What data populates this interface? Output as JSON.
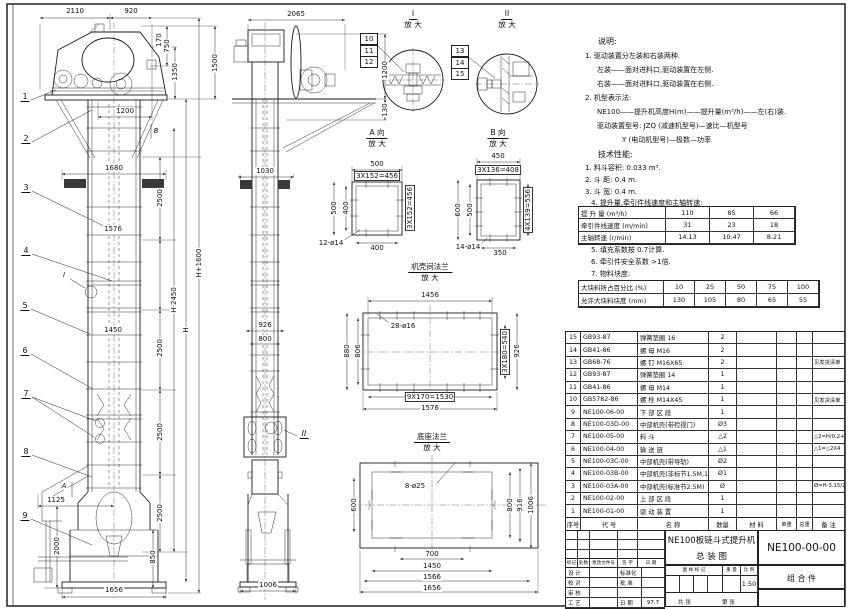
{
  "views": {
    "front": {
      "top_w1": "2110",
      "top_w2": "920",
      "r1": "170",
      "r2": "750",
      "r3": "1350",
      "r4": "1500",
      "discharge": "1200",
      "pad_w": "1680",
      "seg": "2500",
      "flange_w": "1576",
      "inner_w": "1450",
      "h_minus": "H-2450",
      "h": "H",
      "h_plus": "H+1600",
      "inlet": "1125",
      "boot_h1": "2000",
      "boot_h2": "850",
      "base_w": "1656",
      "callouts": [
        "1",
        "2",
        "3",
        "4",
        "5",
        "6",
        "7",
        "8",
        "9"
      ],
      "marker_i": "I",
      "marker_a": "A",
      "marker_b": "B"
    },
    "side": {
      "top_w": "2065",
      "r1": "1200",
      "r2": "130",
      "pad_w": "1030",
      "depth": "926",
      "inner_d": "800",
      "base_w": "1006",
      "marker_ii": "II"
    },
    "detailI": {
      "t": "I",
      "sub": "放 大",
      "c": [
        "10",
        "11",
        "12"
      ]
    },
    "detailII": {
      "t": "II",
      "sub": "放 大",
      "c": [
        "13",
        "14",
        "15"
      ]
    },
    "viewA": {
      "t": "A 向",
      "sub": "放 大",
      "top1": "500",
      "top2": "3X152=456",
      "left1": "500",
      "left2": "400",
      "right1": "3X152=456",
      "bottom": "400",
      "holes": "12-ø14"
    },
    "viewB": {
      "t": "B 向",
      "sub": "放 大",
      "top1": "450",
      "top2": "3X136=408",
      "left1": "600",
      "left2": "500",
      "right1": "4X139=556",
      "bottom": "350",
      "holes": "14-ø14"
    },
    "flange": {
      "t": "机壳间法兰",
      "sub": "放 大",
      "top": "1456",
      "holes": "28-ø16",
      "left1": "880",
      "left2": "806",
      "right1": "3X180=540",
      "right2": "926",
      "bottom1": "9X170=1530",
      "bottom2": "1576"
    },
    "base": {
      "t": "底座法兰",
      "sub": "放 大",
      "holes": "8-ø25",
      "left": "600",
      "right1": "800",
      "right2": "916",
      "right3": "1006",
      "b1": "700",
      "b2": "1450",
      "b3": "1566",
      "b4": "1656"
    }
  },
  "notes": {
    "heading": "说明:",
    "n1": "1. 驱动装置分左装和右装两种.",
    "n2": "左装——面对进料口,驱动装置在左侧.",
    "n3": "右装——面对进料口,驱动装置在右侧.",
    "n4": "2. 机型表示法:",
    "n5": "NE100——提升机高度H(m)——提升量(m³/h)——左(右)装.",
    "n6": "驱动装置型号: JZQ (减速机型号)—速比—机型号",
    "n7": "Y (电动机型号)—极数—功率"
  },
  "specs": {
    "heading": "技术性能:",
    "s1": "1. 料斗容积: 0.033 m³.",
    "s2": "2. 斗  距: 0.4 m.",
    "s3": "3. 斗  宽: 0.4 m.",
    "s4": "4. 提升量,牵引件线速度和主轴转速:",
    "s5": "5. 填充系数按 0.7计算.",
    "s6": "6. 牵引件安全系数 >1倍.",
    "s7": "7. 物料块度:"
  },
  "perf_table": {
    "rows": [
      {
        "label": "提 升 量  (m³/h)",
        "values": [
          "110",
          "85",
          "66"
        ]
      },
      {
        "label": "牵引件线速度 (m/min)",
        "values": [
          "31",
          "23",
          "18"
        ]
      },
      {
        "label": "主轴转速  (r/min)",
        "values": [
          "14.13",
          "10.47",
          "8.21"
        ]
      }
    ]
  },
  "lump_table": {
    "rows": [
      {
        "label": "大块料所占百分比 (%)",
        "values": [
          "10",
          "25",
          "50",
          "75",
          "100"
        ]
      },
      {
        "label": "允许大块料块度 (mm)",
        "values": [
          "130",
          "105",
          "80",
          "65",
          "55"
        ]
      }
    ]
  },
  "bom": {
    "headers": {
      "no": "序号",
      "code": "代  号",
      "name": "名   称",
      "qty": "数量",
      "material": "材  料",
      "unit": "单重",
      "total": "总重",
      "remark": "备 注"
    },
    "rows": [
      {
        "no": "15",
        "code": "GB93-87",
        "name": "弹簧垫圈  16",
        "qty": "2",
        "remark": ""
      },
      {
        "no": "14",
        "code": "GB41-86",
        "name": "螺 母  M16",
        "qty": "2",
        "remark": ""
      },
      {
        "no": "13",
        "code": "GB68-76",
        "name": "螺 钉  M16X65",
        "qty": "2",
        "remark": "见发货清单"
      },
      {
        "no": "12",
        "code": "GB93-87",
        "name": "弹簧垫圈  14",
        "qty": "1",
        "remark": ""
      },
      {
        "no": "11",
        "code": "GB41-86",
        "name": "螺 母  M14",
        "qty": "1",
        "remark": ""
      },
      {
        "no": "10",
        "code": "GB5782-86",
        "name": "螺 栓  M14X45",
        "qty": "1",
        "remark": "见发货清单"
      },
      {
        "no": "9",
        "code": "NE100-06-00",
        "name": "下 部 区 段",
        "qty": "1",
        "remark": ""
      },
      {
        "no": "8",
        "code": "NE100-03D-00",
        "name": "中部机壳(带检视门)",
        "qty": "Ø3",
        "remark": ""
      },
      {
        "no": "7",
        "code": "NE100-05-00",
        "name": "料  斗",
        "qty": "△2",
        "remark": "△2=H/0.2+5.75"
      },
      {
        "no": "6",
        "code": "NE100-04-00",
        "name": "输 送 链",
        "qty": "△1",
        "remark": "△1=△2X4"
      },
      {
        "no": "5",
        "code": "NE100-03C-00",
        "name": "中部机壳(带导轨)",
        "qty": "Ø2",
        "remark": ""
      },
      {
        "no": "4",
        "code": "NE100-03B-00",
        "name": "中部机壳(非标节1.5M,1M)",
        "qty": "Ø1",
        "remark": ""
      },
      {
        "no": "3",
        "code": "NE100-03A-00",
        "name": "中部机壳(标准节2.5M)",
        "qty": "Ø",
        "remark": "Ø=H-3.15/2.5"
      },
      {
        "no": "2",
        "code": "NE100-02-00",
        "name": "上 部 区 段",
        "qty": "1",
        "remark": ""
      },
      {
        "no": "1",
        "code": "NE100-01-00",
        "name": "驱 动 装 置",
        "qty": "1",
        "remark": ""
      }
    ]
  },
  "titleblock": {
    "title1": "NE100板链斗式提升机",
    "title2": "总  装  图",
    "dwg_no": "NE100-00-00",
    "assembly": "组  合  件",
    "rev": {
      "mark": "标记",
      "count": "处数",
      "doc": "更改文件号",
      "sign": "签 字",
      "date": "日 期"
    },
    "staff": {
      "design": "设 计",
      "check": "校 对",
      "review": "审 核",
      "process": "工 艺",
      "std": "标准化",
      "approve": "批 准",
      "date_label": "日 期",
      "date_val": "97.7"
    },
    "mark_label": "图 样 标 记",
    "weight_label": "重 量",
    "scale_label": "比 例",
    "scale": "1:50",
    "sheets": "共   张",
    "sheet": "第   张"
  }
}
